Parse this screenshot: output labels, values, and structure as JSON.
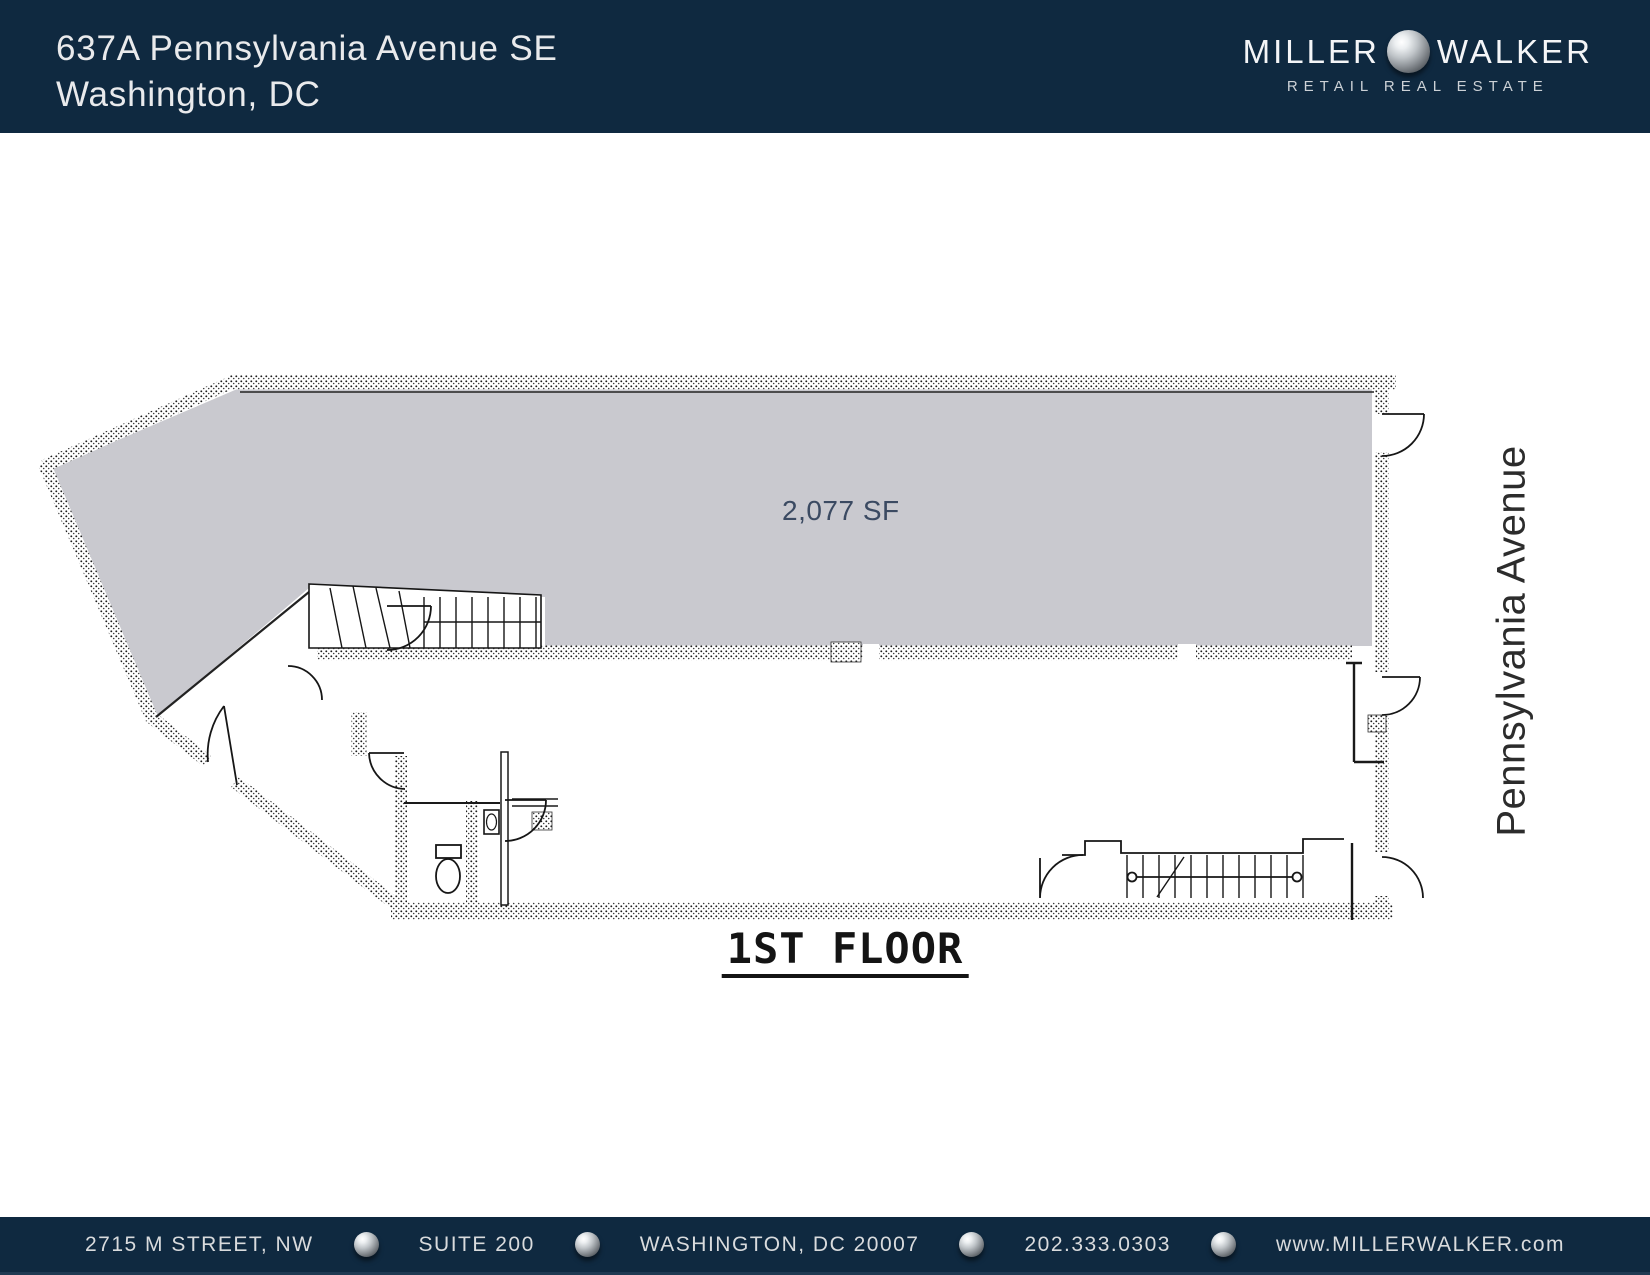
{
  "header": {
    "address_line1": "637A Pennsylvania Avenue SE",
    "address_line2": "Washington, DC",
    "logo": {
      "word1": "MILLER",
      "word2": "WALKER",
      "tagline": "RETAIL REAL ESTATE"
    }
  },
  "floor_plan": {
    "area_label": "2,077 SF",
    "floor_label": "1ST FLOOR",
    "street_label": "Pennsylvania Avenue"
  },
  "footer": {
    "items": [
      "2715 M STREET, NW",
      "SUITE 200",
      "WASHINGTON, DC 20007",
      "202.333.0303",
      "www.MILLERWALKER.com"
    ]
  },
  "colors": {
    "navy": "#0f2940",
    "plan_gray": "#c9c9cf",
    "header_text": "#e9eaec",
    "footer_text": "#d9dbdd",
    "area_text": "#3b4a62",
    "street_text": "#2c2c2c",
    "line": "#1a1a1a"
  }
}
